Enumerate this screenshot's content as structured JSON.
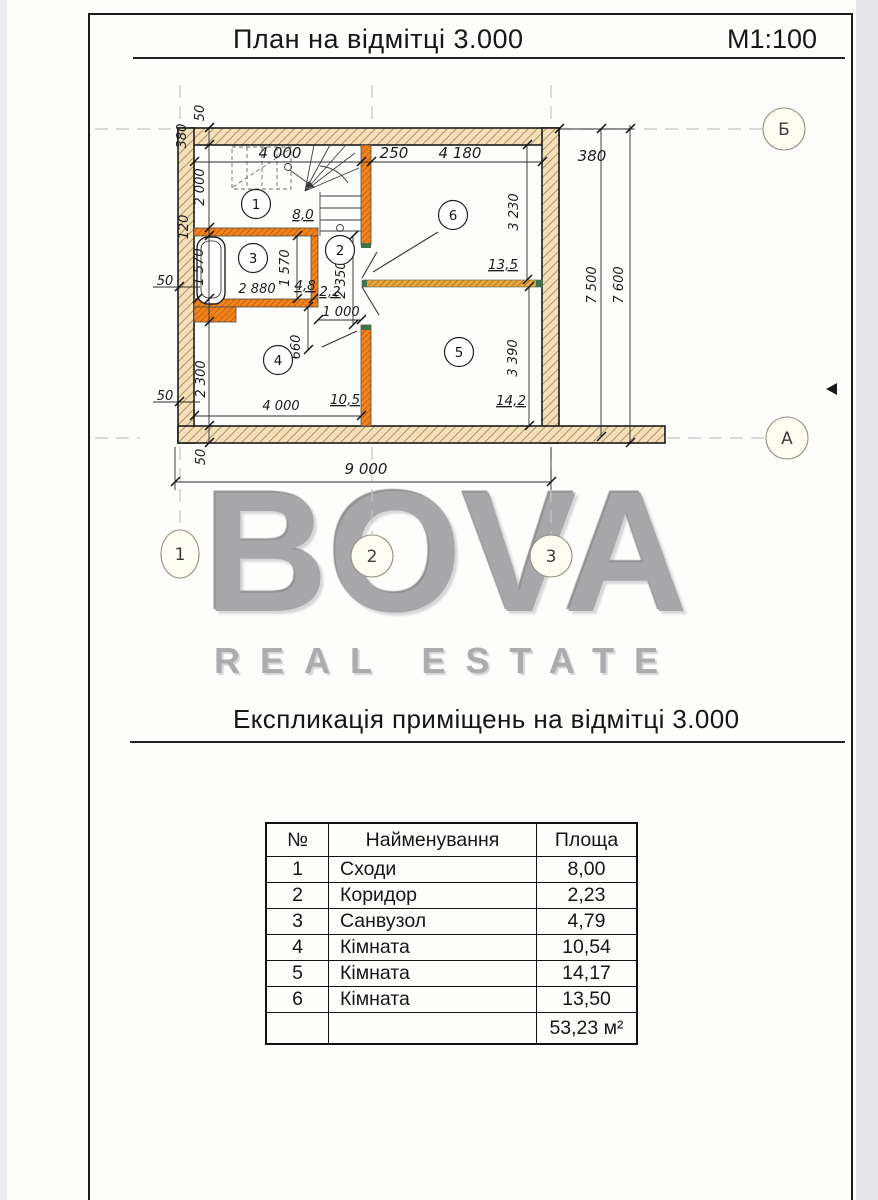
{
  "header": {
    "title": "План на відмітці 3.000",
    "scale": "М1:100"
  },
  "watermark": {
    "line1": "BOVA",
    "line2": "REAL ESTATE"
  },
  "section": {
    "title": "Експликація приміщень на відмітці 3.000"
  },
  "plan": {
    "axes": {
      "b": "Б",
      "a": "А",
      "c1": "1",
      "c2": "2",
      "c3": "3"
    },
    "rooms": {
      "r1": "1",
      "r2": "2",
      "r3": "3",
      "r4": "4",
      "r5": "5",
      "r6": "6"
    },
    "areas": {
      "r1": "8,0",
      "r2": "2,2",
      "r3": "4,8",
      "r4": "10,5",
      "r5": "14,2",
      "r6": "13,5"
    },
    "dims": {
      "top_4000": "4 000",
      "top_250": "250",
      "top_4180": "4 180",
      "top_right_380": "380",
      "right_7500": "7 500",
      "right_7600": "7 600",
      "left_50_top": "50",
      "left_380": "380",
      "left_2000": "2 000",
      "left_120": "120",
      "left_1570": "1 570",
      "left_50_mid": "50",
      "left_2300": "2 300",
      "left_50_low": "50",
      "left_50_bottom": "50",
      "bottom_9000": "9 000",
      "in_2880": "2 880",
      "in_1570": "1 570",
      "in_2350": "2 350",
      "in_1000": "1 000",
      "in_660": "660",
      "in_4000": "4 000",
      "in_3230": "3 230",
      "in_3390": "3 390"
    },
    "colors": {
      "wall_hatch_fill": "#f2e0bd",
      "partition_orange": "#f5831d",
      "divider_amber": "#eaa93f",
      "frame_green": "#41734d",
      "watermark_gray": "#a7a7a9"
    }
  },
  "table": {
    "headers": [
      "№",
      "Найменування",
      "Площа"
    ],
    "rows": [
      [
        "1",
        "Сходи",
        "8,00"
      ],
      [
        "2",
        "Коридор",
        "2,23"
      ],
      [
        "3",
        "Санвузол",
        "4,79"
      ],
      [
        "4",
        "Кімната",
        "10,54"
      ],
      [
        "5",
        "Кімната",
        "14,17"
      ],
      [
        "6",
        "Кімната",
        "13,50"
      ]
    ],
    "total": "53,23 м²"
  }
}
